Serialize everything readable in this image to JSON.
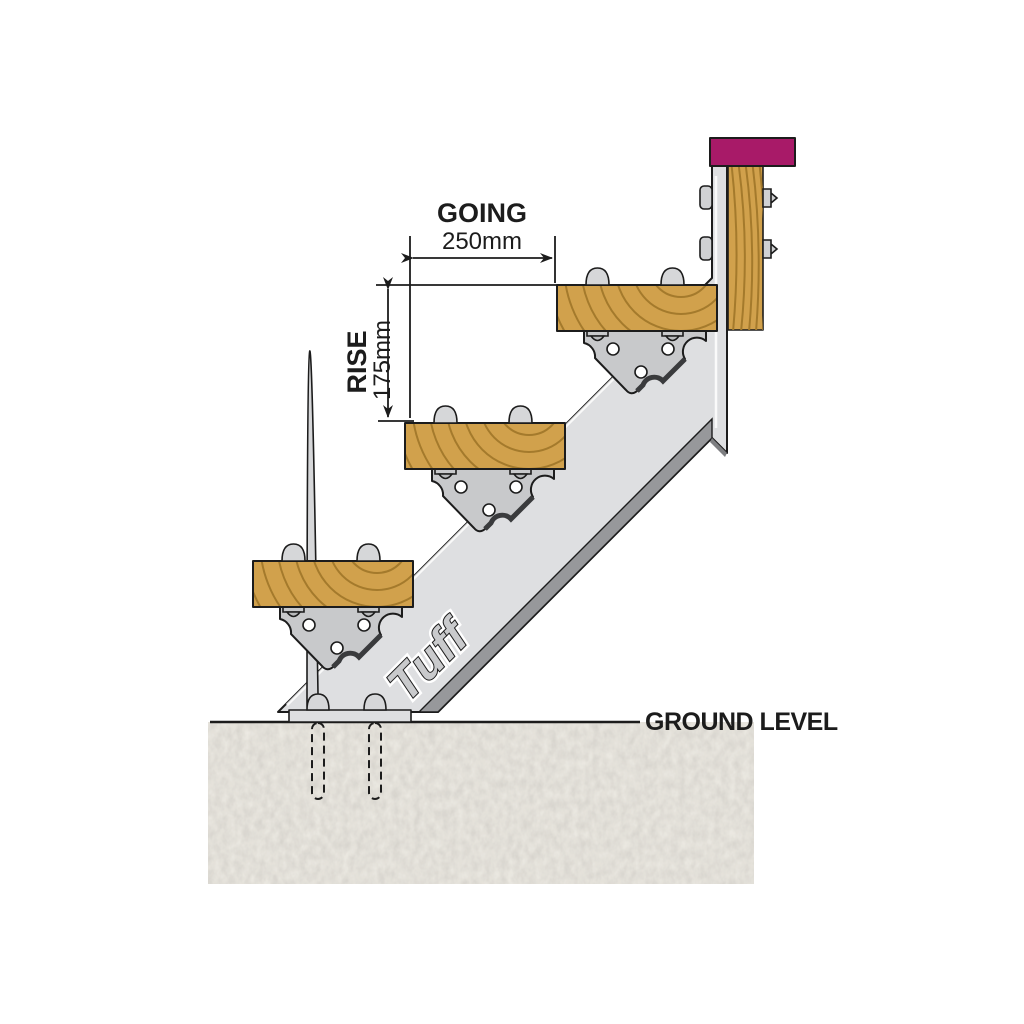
{
  "diagram": {
    "brand_logo": "Tuff",
    "dimensions": {
      "going": {
        "label": "GOING",
        "value": "250mm"
      },
      "rise": {
        "label": "RISE",
        "value": "175mm"
      }
    },
    "ground": {
      "label": "GROUND LEVEL"
    },
    "steps_count": "3"
  },
  "colors": {
    "wood": "#d1a14c",
    "wood_grain": "#a47a2c",
    "metal": "#dedfe1",
    "metal_shadow": "#97989b",
    "metal_cut": "#7e7f82",
    "bracket": "#c8c9cb",
    "cap": "#a81a68",
    "ground_fill": "#c9c5bd",
    "line": "#1c1c1c"
  }
}
